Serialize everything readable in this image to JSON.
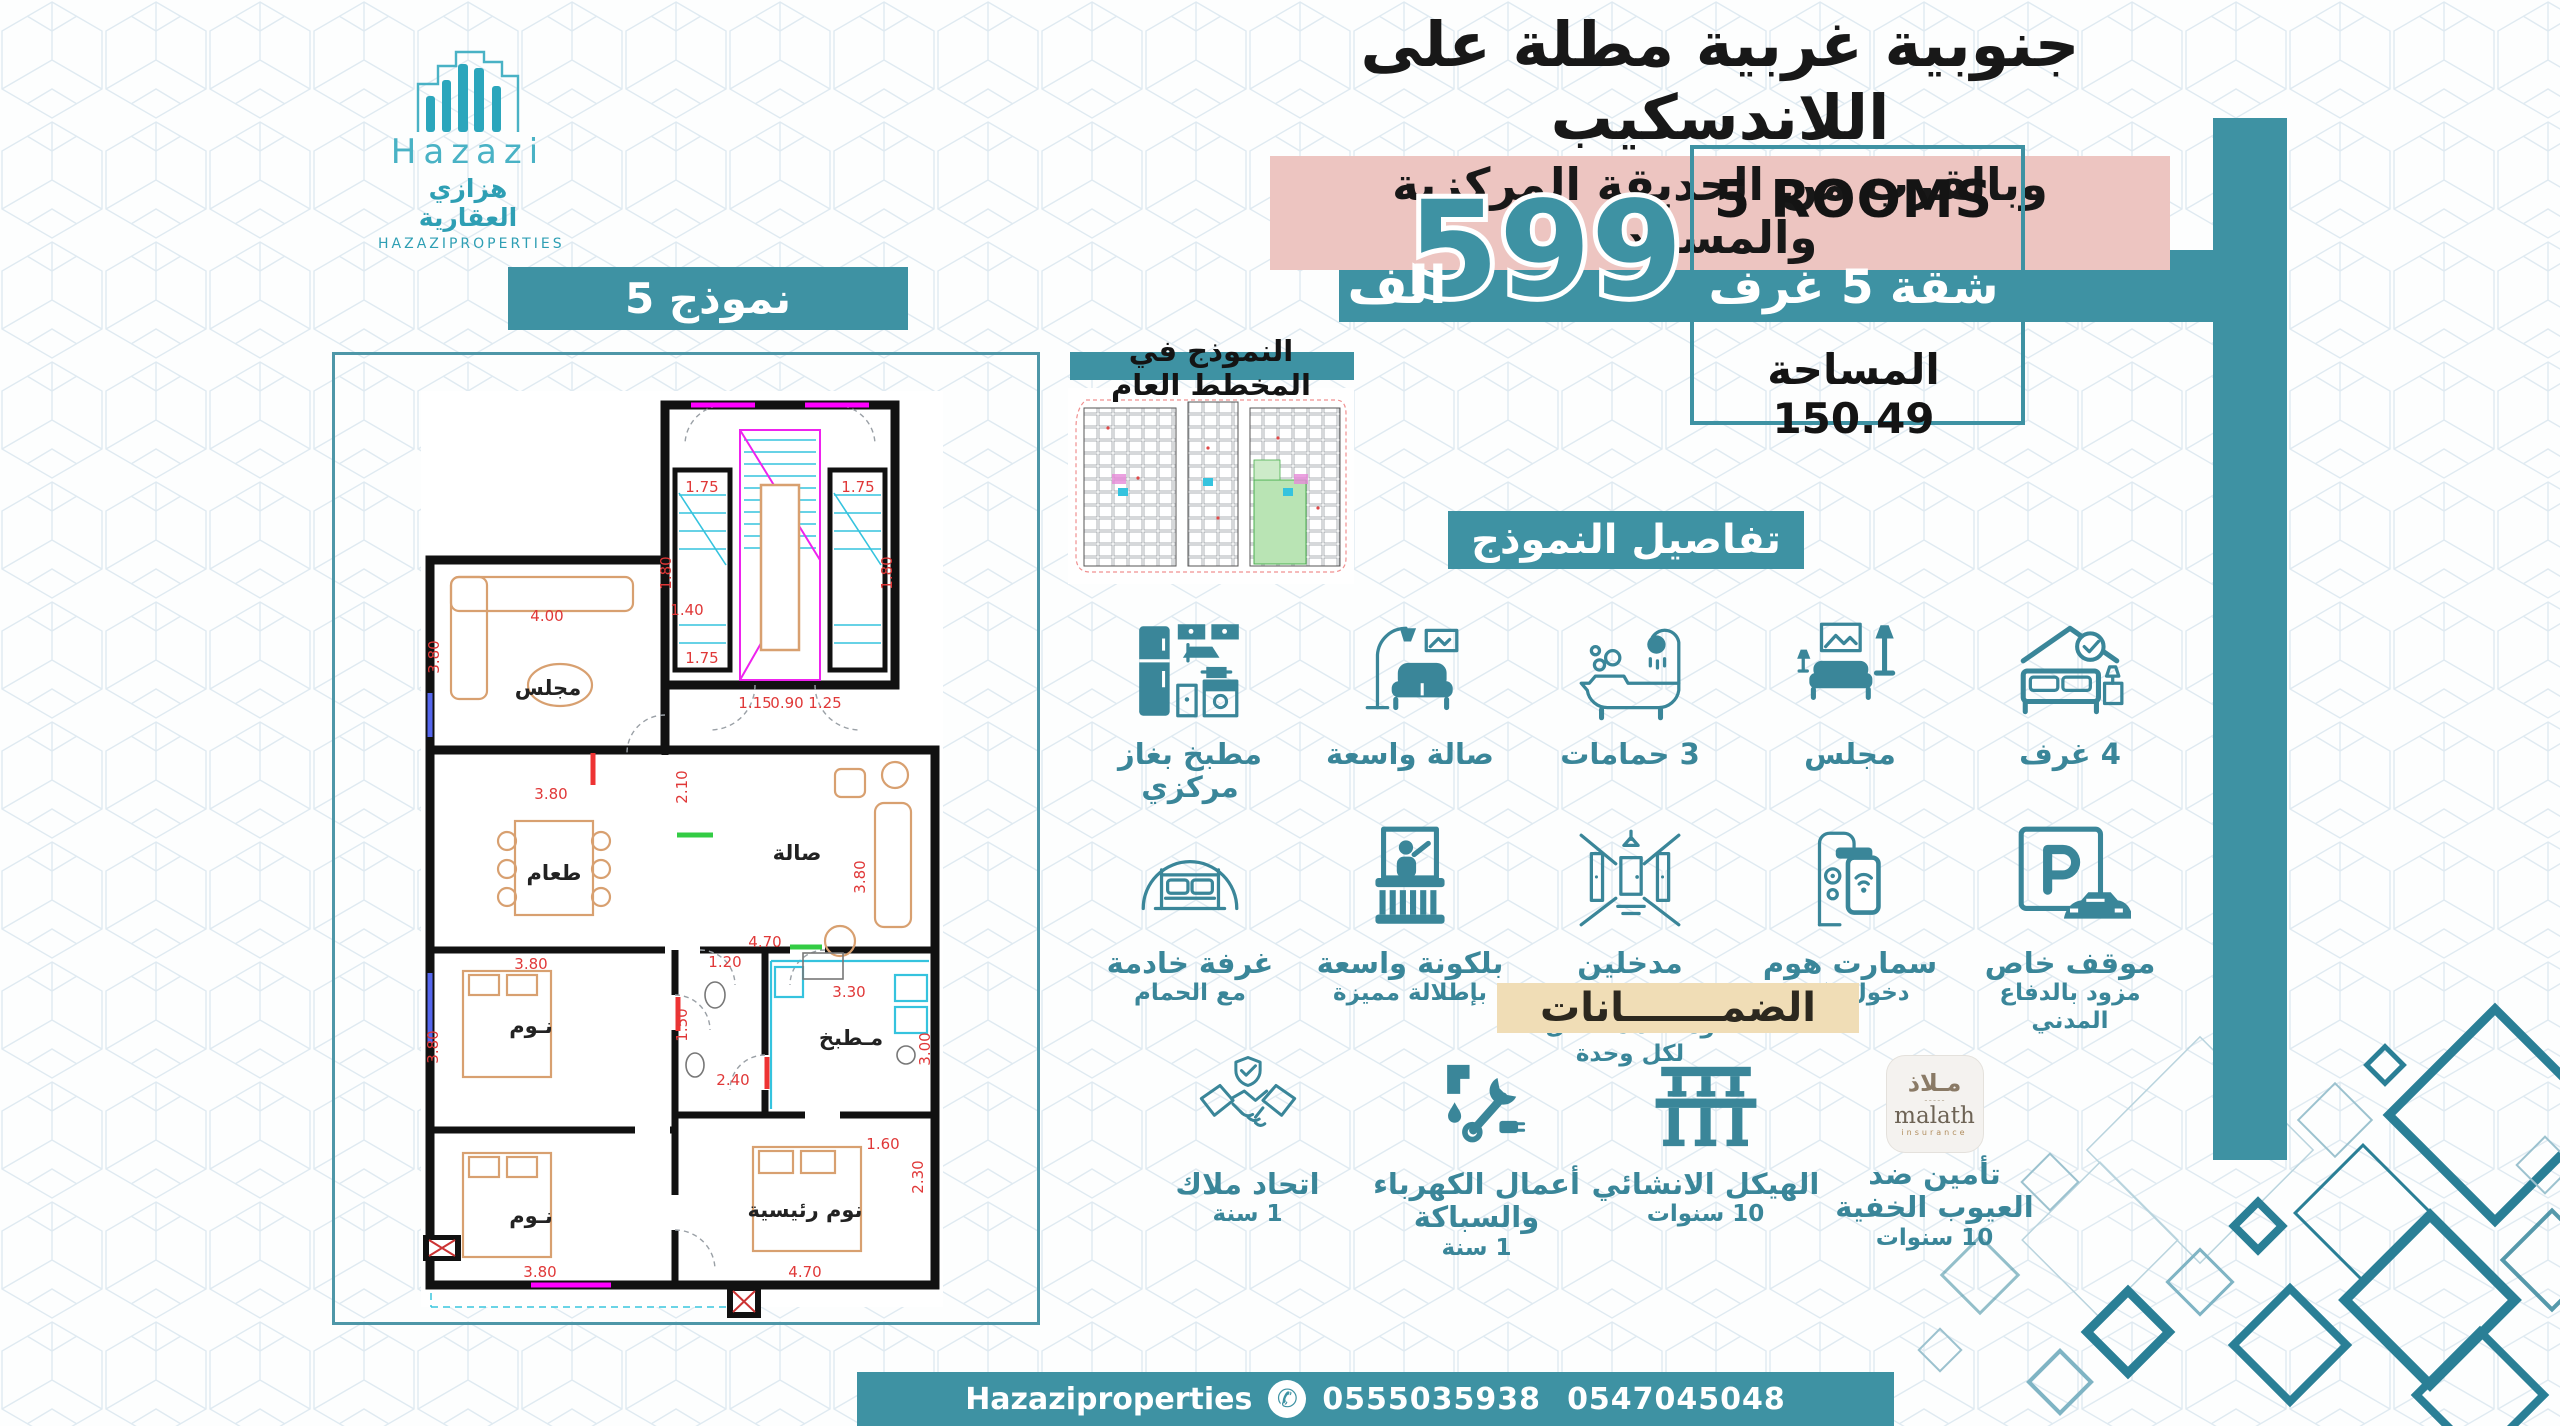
{
  "brand": {
    "en": "Hazazi",
    "ar": "هزازي العقارية",
    "caps": "HAZAZIPROPERTIES"
  },
  "header": {
    "line1": "جنوبية غربية مطلة على اللاندسكيب",
    "line2": "وبالقرب من الحديقة المركزية والمسجد"
  },
  "model_badge": "نموذج 5",
  "price": {
    "amount": "599",
    "unit": "الف"
  },
  "info_box": {
    "rooms_en": "5 ROOMS",
    "rooms_ar": "شقة 5 غرف",
    "area": "المساحة 150.49"
  },
  "site_plan": {
    "caption": "النموذج في المخطط العام"
  },
  "details": {
    "heading": "تفاصيل النموذج",
    "features": [
      {
        "icon": "bed-check-icon",
        "label": "4 غرف",
        "sub": ""
      },
      {
        "icon": "majlis-sofa-icon",
        "label": "مجلس",
        "sub": ""
      },
      {
        "icon": "bathtub-icon",
        "label": "3 حمامات",
        "sub": ""
      },
      {
        "icon": "armchair-lamp-icon",
        "label": "صالة واسعة",
        "sub": ""
      },
      {
        "icon": "kitchen-icon",
        "label": "مطبخ بغاز مركزي",
        "sub": ""
      },
      {
        "icon": "parking-icon",
        "label": "موقف خاص",
        "sub": "مزود بالدفاع المدني"
      },
      {
        "icon": "smart-lock-icon",
        "label": "سمارت هوم",
        "sub": "دخول ذكي"
      },
      {
        "icon": "hallway-icon",
        "label": "مدخلين مستقلين",
        "sub": "ومصعد مستقل لكل وحدة"
      },
      {
        "icon": "balcony-icon",
        "label": "بلكونة واسعة",
        "sub": "بإطلالة مميزة"
      },
      {
        "icon": "maid-room-icon",
        "label": "غرفة خادمة",
        "sub": "مع الحمام"
      }
    ]
  },
  "guarantees": {
    "heading": "الضمـــــــانات",
    "items": [
      {
        "icon": "malath-logo",
        "label": "تأمين ضد العيوب الخفية",
        "sub": "10 سنوات"
      },
      {
        "icon": "structure-icon",
        "label": "الهيكل الانشائي",
        "sub": "10 سنوات"
      },
      {
        "icon": "tools-icon",
        "label": "أعمال الكهرباء والسباكة",
        "sub": "1 سنة"
      },
      {
        "icon": "handshake-icon",
        "label": "اتحاد ملاك",
        "sub": "1 سنة"
      }
    ]
  },
  "malath": {
    "ar": "مـلاذ",
    "dots": "ـ ـ ـ ـ ـ",
    "en": "malath",
    "sub": "insurance"
  },
  "footer": {
    "brand": "Hazaziproperties",
    "phone_icon": "✆",
    "phone1": "0555035938",
    "phone2": "0547045048"
  },
  "floor_plan": {
    "rooms": [
      "مجلس",
      "طعام",
      "صالة",
      "نـوم",
      "مـطبخ",
      "نـوم",
      "نوم رئيسية"
    ],
    "dims": [
      "1.75",
      "1.80",
      "1.75",
      "1.75",
      "1.80",
      "1.15",
      "0.90",
      "1.25",
      "4.00",
      "3.80",
      "1.40",
      "2.10",
      "3.80",
      "3.80",
      "4.70",
      "3.80",
      "3.80",
      "1.20",
      "3.30",
      "3.00",
      "2.40",
      "1.50",
      "1.60",
      "2.30",
      "3.80",
      "4.70"
    ]
  }
}
